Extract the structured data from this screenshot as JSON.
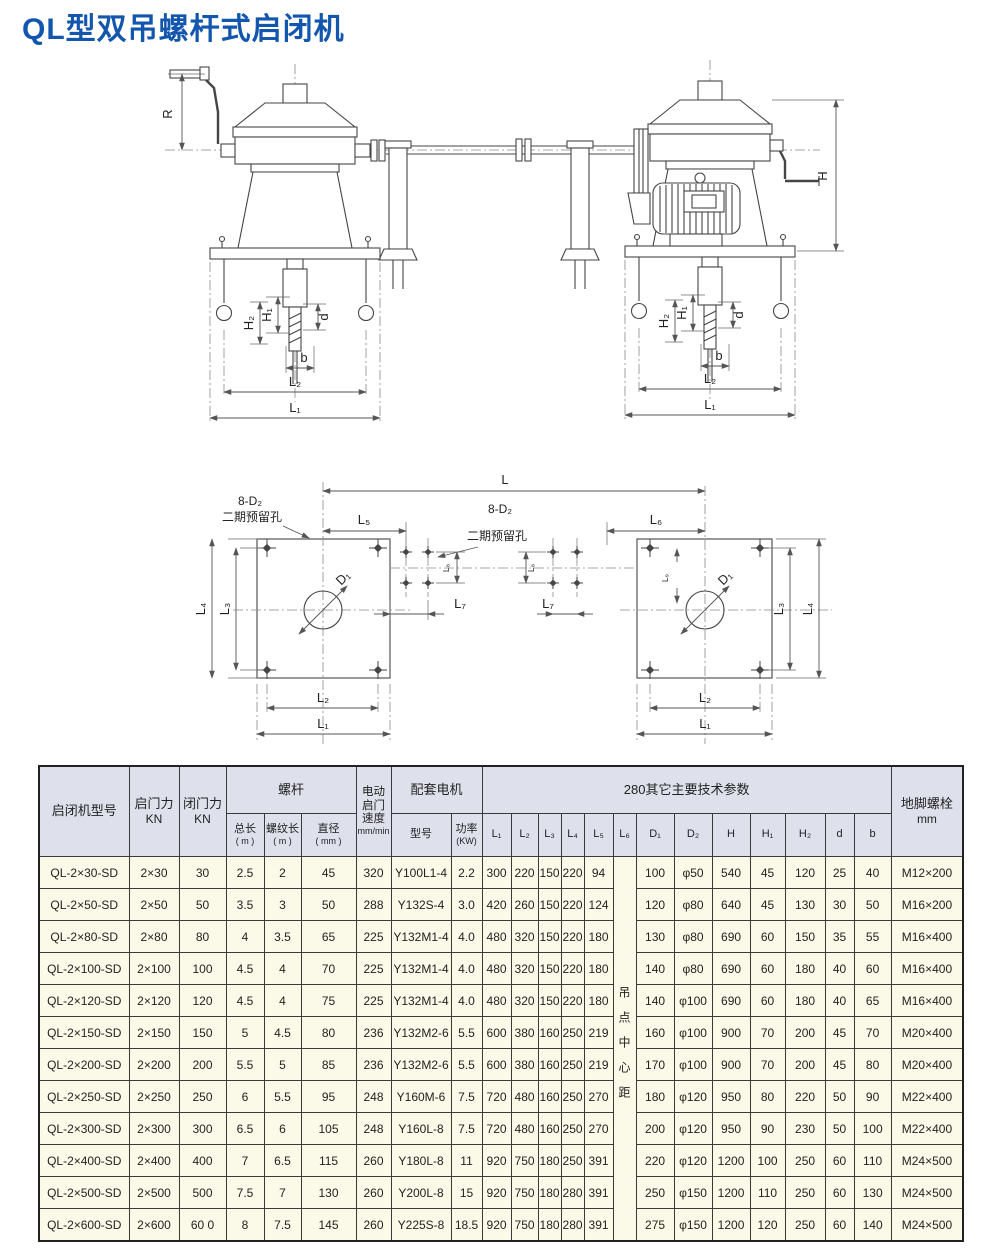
{
  "page": {
    "title": "QL型双吊螺杆式启闭机"
  },
  "drawing": {
    "labels": {
      "R": "R",
      "H": "H",
      "H1": "H₁",
      "H2": "H₂",
      "d": "d",
      "b": "b",
      "L": "L",
      "L1": "L₁",
      "L2": "L₂",
      "L3": "L₃",
      "L4": "L₄",
      "L5": "L₅",
      "L6": "L₆",
      "L7": "L₇",
      "L8": "L₈",
      "L9": "L₉",
      "D1": "D₁",
      "note_8d2": "8-D₂",
      "note_reserved": "二期预留孔"
    }
  },
  "table": {
    "headers": {
      "model": "启闭机型号",
      "opening_force": "启门力",
      "opening_force_unit": "KN",
      "closing_force": "闭门力",
      "closing_force_unit": "KN",
      "screw_group": "螺杆",
      "screw_total": "总长",
      "screw_total_unit": "( m )",
      "screw_thread": "螺纹长",
      "screw_thread_unit": "( m )",
      "screw_dia": "直径",
      "screw_dia_unit": "( mm )",
      "speed": "电动启门速度",
      "speed_unit": "mm/min",
      "motor_group": "配套电机",
      "motor_model": "型号",
      "motor_power": "功率",
      "motor_power_unit": "(KW)",
      "params_group": "280其它主要技术参数",
      "col_L1": "L₁",
      "col_L2": "L₂",
      "col_L3": "L₃",
      "col_L4": "L₄",
      "col_L5": "L₅",
      "col_L6": "L₆",
      "col_D1": "D₁",
      "col_D2": "D₂",
      "col_H": "H",
      "col_H1": "H₁",
      "col_H2": "H₂",
      "col_d": "d",
      "col_b": "b",
      "anchor_bolt": "地脚螺栓",
      "anchor_bolt_unit": "mm",
      "hoist_center_note": "吊点中心距"
    },
    "rows": [
      {
        "model": "QL-2×30-SD",
        "open": "2×30",
        "close": "30",
        "total": "2.5",
        "thread": "2",
        "dia": "45",
        "speed": "320",
        "motor": "Y100L1-4",
        "power": "2.2",
        "L1": "300",
        "L2": "220",
        "L3": "150",
        "L4": "220",
        "L5": "94",
        "D1": "100",
        "D2": "φ50",
        "H": "540",
        "H1": "45",
        "H2": "120",
        "d": "25",
        "b": "40",
        "bolt": "M12×200"
      },
      {
        "model": "QL-2×50-SD",
        "open": "2×50",
        "close": "50",
        "total": "3.5",
        "thread": "3",
        "dia": "50",
        "speed": "288",
        "motor": "Y132S-4",
        "power": "3.0",
        "L1": "420",
        "L2": "260",
        "L3": "150",
        "L4": "220",
        "L5": "124",
        "D1": "120",
        "D2": "φ80",
        "H": "640",
        "H1": "45",
        "H2": "130",
        "d": "30",
        "b": "50",
        "bolt": "M16×200"
      },
      {
        "model": "QL-2×80-SD",
        "open": "2×80",
        "close": "80",
        "total": "4",
        "thread": "3.5",
        "dia": "65",
        "speed": "225",
        "motor": "Y132M1-4",
        "power": "4.0",
        "L1": "480",
        "L2": "320",
        "L3": "150",
        "L4": "220",
        "L5": "180",
        "D1": "130",
        "D2": "φ80",
        "H": "690",
        "H1": "60",
        "H2": "150",
        "d": "35",
        "b": "55",
        "bolt": "M16×400"
      },
      {
        "model": "QL-2×100-SD",
        "open": "2×100",
        "close": "100",
        "total": "4.5",
        "thread": "4",
        "dia": "70",
        "speed": "225",
        "motor": "Y132M1-4",
        "power": "4.0",
        "L1": "480",
        "L2": "320",
        "L3": "150",
        "L4": "220",
        "L5": "180",
        "D1": "140",
        "D2": "φ80",
        "H": "690",
        "H1": "60",
        "H2": "180",
        "d": "40",
        "b": "60",
        "bolt": "M16×400"
      },
      {
        "model": "QL-2×120-SD",
        "open": "2×120",
        "close": "120",
        "total": "4.5",
        "thread": "4",
        "dia": "75",
        "speed": "225",
        "motor": "Y132M1-4",
        "power": "4.0",
        "L1": "480",
        "L2": "320",
        "L3": "150",
        "L4": "220",
        "L5": "180",
        "D1": "140",
        "D2": "φ100",
        "H": "690",
        "H1": "60",
        "H2": "180",
        "d": "40",
        "b": "65",
        "bolt": "M16×400"
      },
      {
        "model": "QL-2×150-SD",
        "open": "2×150",
        "close": "150",
        "total": "5",
        "thread": "4.5",
        "dia": "80",
        "speed": "236",
        "motor": "Y132M2-6",
        "power": "5.5",
        "L1": "600",
        "L2": "380",
        "L3": "160",
        "L4": "250",
        "L5": "219",
        "D1": "160",
        "D2": "φ100",
        "H": "900",
        "H1": "70",
        "H2": "200",
        "d": "45",
        "b": "70",
        "bolt": "M20×400"
      },
      {
        "model": "QL-2×200-SD",
        "open": "2×200",
        "close": "200",
        "total": "5.5",
        "thread": "5",
        "dia": "85",
        "speed": "236",
        "motor": "Y132M2-6",
        "power": "5.5",
        "L1": "600",
        "L2": "380",
        "L3": "160",
        "L4": "250",
        "L5": "219",
        "D1": "170",
        "D2": "φ100",
        "H": "900",
        "H1": "70",
        "H2": "200",
        "d": "45",
        "b": "80",
        "bolt": "M20×400"
      },
      {
        "model": "QL-2×250-SD",
        "open": "2×250",
        "close": "250",
        "total": "6",
        "thread": "5.5",
        "dia": "95",
        "speed": "248",
        "motor": "Y160M-6",
        "power": "7.5",
        "L1": "720",
        "L2": "480",
        "L3": "160",
        "L4": "250",
        "L5": "270",
        "D1": "180",
        "D2": "φ120",
        "H": "950",
        "H1": "80",
        "H2": "220",
        "d": "50",
        "b": "90",
        "bolt": "M22×400"
      },
      {
        "model": "QL-2×300-SD",
        "open": "2×300",
        "close": "300",
        "total": "6.5",
        "thread": "6",
        "dia": "105",
        "speed": "248",
        "motor": "Y160L-8",
        "power": "7.5",
        "L1": "720",
        "L2": "480",
        "L3": "160",
        "L4": "250",
        "L5": "270",
        "D1": "200",
        "D2": "φ120",
        "H": "950",
        "H1": "90",
        "H2": "230",
        "d": "50",
        "b": "100",
        "bolt": "M22×400"
      },
      {
        "model": "QL-2×400-SD",
        "open": "2×400",
        "close": "400",
        "total": "7",
        "thread": "6.5",
        "dia": "115",
        "speed": "260",
        "motor": "Y180L-8",
        "power": "11",
        "L1": "920",
        "L2": "750",
        "L3": "180",
        "L4": "250",
        "L5": "391",
        "D1": "220",
        "D2": "φ120",
        "H": "1200",
        "H1": "100",
        "H2": "250",
        "d": "60",
        "b": "110",
        "bolt": "M24×500"
      },
      {
        "model": "QL-2×500-SD",
        "open": "2×500",
        "close": "500",
        "total": "7.5",
        "thread": "7",
        "dia": "130",
        "speed": "260",
        "motor": "Y200L-8",
        "power": "15",
        "L1": "920",
        "L2": "750",
        "L3": "180",
        "L4": "280",
        "L5": "391",
        "D1": "250",
        "D2": "φ150",
        "H": "1200",
        "H1": "110",
        "H2": "250",
        "d": "60",
        "b": "130",
        "bolt": "M24×500"
      },
      {
        "model": "QL-2×600-SD",
        "open": "2×600",
        "close": "60 0",
        "total": "8",
        "thread": "7.5",
        "dia": "145",
        "speed": "260",
        "motor": "Y225S-8",
        "power": "18.5",
        "L1": "920",
        "L2": "750",
        "L3": "180",
        "L4": "280",
        "L5": "391",
        "D1": "275",
        "D2": "φ150",
        "H": "1200",
        "H1": "120",
        "H2": "250",
        "d": "60",
        "b": "140",
        "bolt": "M24×500"
      }
    ]
  }
}
